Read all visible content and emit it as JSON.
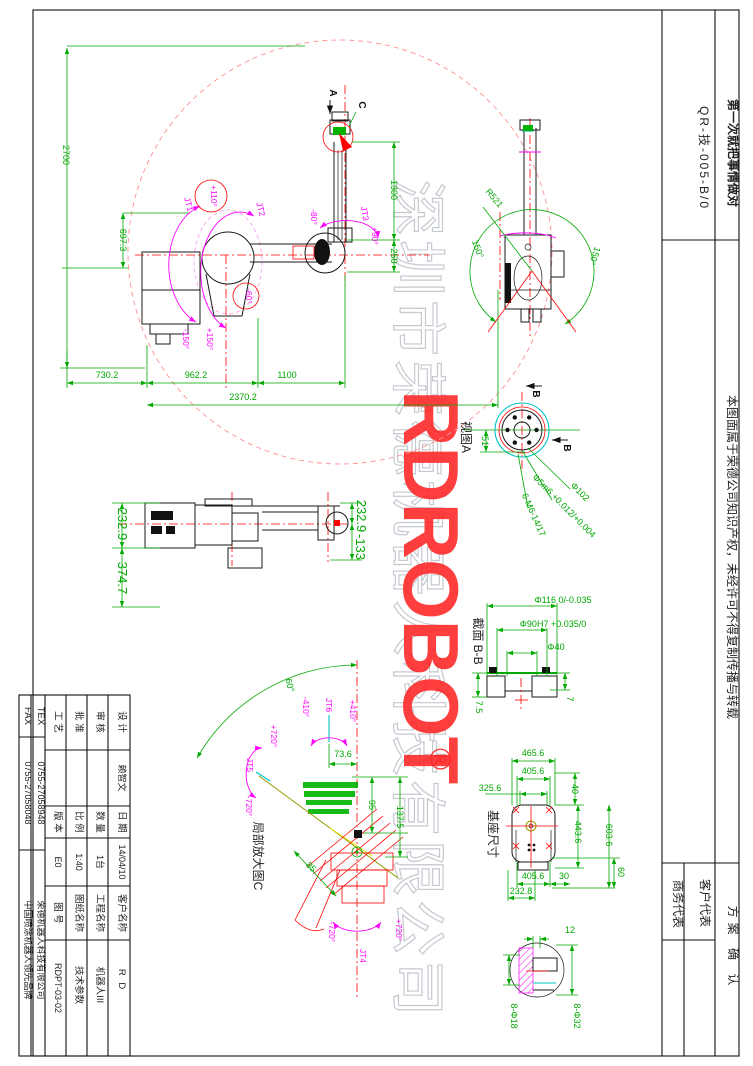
{
  "frame": {
    "doc_number": "QR-技-005-B/0",
    "slogan": "第一次就把事情做对",
    "notice": "本图面属于荣德公司知识产权，未经许可不得复制传播与转载",
    "approval_title": "方案 确 认",
    "customer_rep": "客户代表",
    "business_rep": "商务代表"
  },
  "title_block": {
    "design_label": "设 计",
    "design_value": "赖智文",
    "date_label": "日 期",
    "date_value": "14/04/10",
    "customer_label": "客户名称",
    "customer_value": "R D",
    "check_label": "审 核",
    "check_value": "",
    "qty_label": "数 量",
    "qty_value": "1台",
    "project_label": "工程名称",
    "project_value": "机器人III",
    "approve_label": "批 准",
    "approve_value": "",
    "scale_label": "比 例",
    "scale_value": "1:40",
    "drawing_name_label": "图纸名称",
    "drawing_name_value": "技术参数",
    "process_label": "工 艺",
    "process_value": "",
    "version_label": "版 本",
    "version_value": "E0",
    "drawing_no_label": "图 号",
    "drawing_no_value": "RDPT-03-02",
    "tex_label": "TEX",
    "tex_value": "0755-27058948",
    "fax_label": "FAX",
    "fax_value": "0755-27058048",
    "company": "荣德机器人科技有限公司",
    "brand": "中国喷涂机器人领先品牌"
  },
  "watermark": {
    "brand": "RDROBOT",
    "registered": "®",
    "company": "深圳市荣德机器人科技有限公司"
  },
  "front_view": {
    "d2700": "2700",
    "d697": "697.3",
    "d730": "730.2",
    "d962": "962.2",
    "d1100": "1100",
    "d2370": "2370.2",
    "d1300": "1300",
    "d250": "250",
    "jt1": "JT1",
    "jt1_max": "+110°",
    "jt1_min": "-150°",
    "jt2": "JT2",
    "jt2_min": "-60°",
    "jt2_max": "+150°",
    "jt3": "JT3",
    "jt3_min": "-80°",
    "jt3_max": "+90°",
    "view_a_marker": "A",
    "detail_c_marker": "C"
  },
  "top_view": {
    "r521": "R521",
    "angle_left": "150°",
    "angle_right": "150°"
  },
  "side_view": {
    "d232_left": "232.9",
    "d374": "374.7",
    "d232_right": "232.9",
    "d133": "-133"
  },
  "view_a": {
    "label": "视图A",
    "d51": "51",
    "dia102": "Φ102",
    "pin_fit": "Φ5m6 +0.012/+0.004",
    "tapped": "6-M6-14/17",
    "section_mark_top": "B",
    "section_mark_bottom": "B"
  },
  "section_bb": {
    "label": "截面 B-B",
    "dia116": "Φ116 0/-0.035",
    "dia90": "Φ90H7 +0.035/0",
    "dia40": "Φ40",
    "d75": "7.5",
    "d7": "7"
  },
  "base_view": {
    "label": "基座尺寸",
    "d465": "465.6",
    "d405_top": "405.6",
    "d325": "325.6",
    "d40": "40",
    "d443": "443.6",
    "d603": "603.6",
    "d405_bottom": "405.6",
    "d30": "30",
    "d60": "60",
    "d232": "232.8"
  },
  "detail_c": {
    "label": "局部放大图C",
    "d60": "60°",
    "jt6": "JT6",
    "jt6_min": "-410°",
    "jt6_max": "+410°",
    "jt5": "JT5",
    "jt5_max": "+720°",
    "jt5_min": "-720°",
    "jt4": "JT4",
    "jt4_min": "-720°",
    "jt4_max": "+720°",
    "d73": "73.6",
    "d95": "95",
    "d137": "137.5",
    "d85": "85"
  },
  "mount_detail": {
    "d12": "12",
    "holes18": "8-Φ18",
    "holes32": "8-Φ32"
  }
}
